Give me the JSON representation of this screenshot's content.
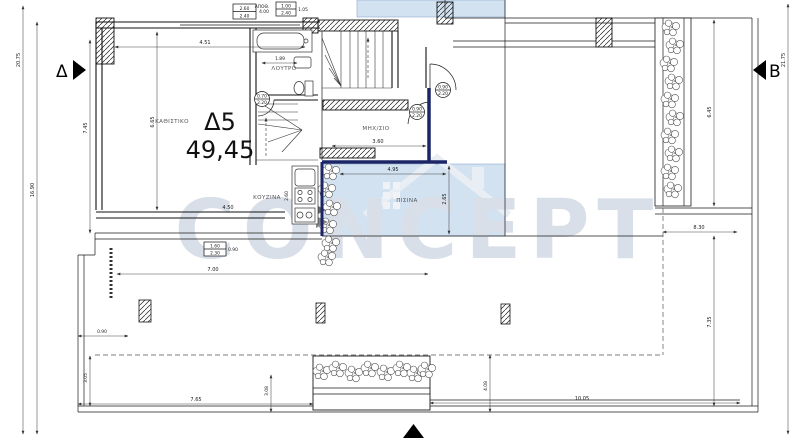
{
  "plan": {
    "unit": {
      "label": "Δ5",
      "area": "49,45"
    },
    "rooms": {
      "living": "ΚΑΘΙΣΤΙΚΟ",
      "bath": "ΛΟΥΤΡΟ",
      "kitchen": "ΚΟΥΖΙΝΑ",
      "machine": "ΜΗΧ/ΣΙΟ",
      "pool": "ΠΙΣΙΝΑ",
      "storage": "ΑΠΟΘ."
    },
    "section_markers": {
      "left": "Δ",
      "right": "B"
    },
    "watermark": {
      "text": "CONCEPT"
    },
    "dimensions": {
      "left_total": "20.75",
      "left_partial": "16.90",
      "left_inner_height": "7.45",
      "top_wall": "4.51",
      "living_width": "6.65",
      "bath_fixture": "1.89",
      "living_bottom": "4.50",
      "machine_width": "3.60",
      "pool_width": "4.95",
      "pool_height": "2.65",
      "kitchen_depth": "2.60",
      "terrace_front": "7.00",
      "left_step": "0.90",
      "left_lower": "3.05",
      "bottom_left": "7.65",
      "planter_offset": "3.08",
      "bottom_right": "10.05",
      "terrace_depth": "4.08",
      "right_upper": "8.30",
      "right_planter": "6.45",
      "right_lower": "7.35",
      "right_total": "21.75"
    },
    "openings": {
      "window_top_main": {
        "line1": "2.60",
        "line2": "2.40",
        "side": "4.00"
      },
      "window_top_small": {
        "line1": "1.00",
        "line2": "2.40",
        "side": "1.05"
      },
      "window_bottom": {
        "line1": "1.60",
        "line2": "2.30",
        "side": "0.90"
      },
      "door_bath": {
        "line1": "0.70",
        "line2": "2.20"
      },
      "door_machine_top": {
        "line1": "0.90",
        "line2": "2.20"
      },
      "door_machine_side": {
        "line1": "0.90",
        "line2": "2.20"
      }
    }
  }
}
